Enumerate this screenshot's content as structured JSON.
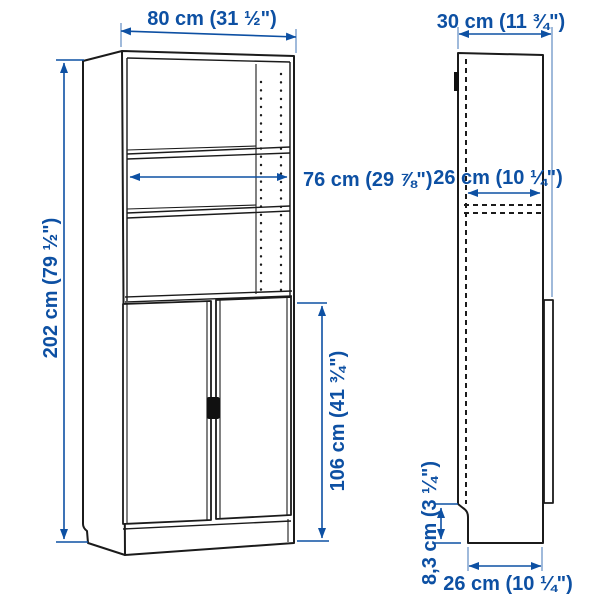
{
  "page": {
    "background": "#ffffff"
  },
  "diagram": {
    "type": "product-dimension-diagram",
    "product": "tall bookcase with two doors",
    "accent_color": "#0d50a3",
    "line_color": "#1b1b1b",
    "views": [
      {
        "id": "front",
        "description": "front three-quarter view of bookcase with open shelves above and double doors below"
      },
      {
        "id": "side",
        "description": "side profile view with dashed interior lines and plinth notch"
      }
    ],
    "dimensions": {
      "width": "80 cm (31 ½\")",
      "depth": "30 cm (11 ¾\")",
      "height": "202 cm (79 ½\")",
      "inner_width": "76 cm (29 ⅞\")",
      "inner_depth": "26 cm (10 ¼\")",
      "door_height": "106 cm (41 ¾\")",
      "plinth_height": "8,3 cm (3 ¼\")",
      "base_depth": "26 cm (10 ¼\")"
    }
  }
}
